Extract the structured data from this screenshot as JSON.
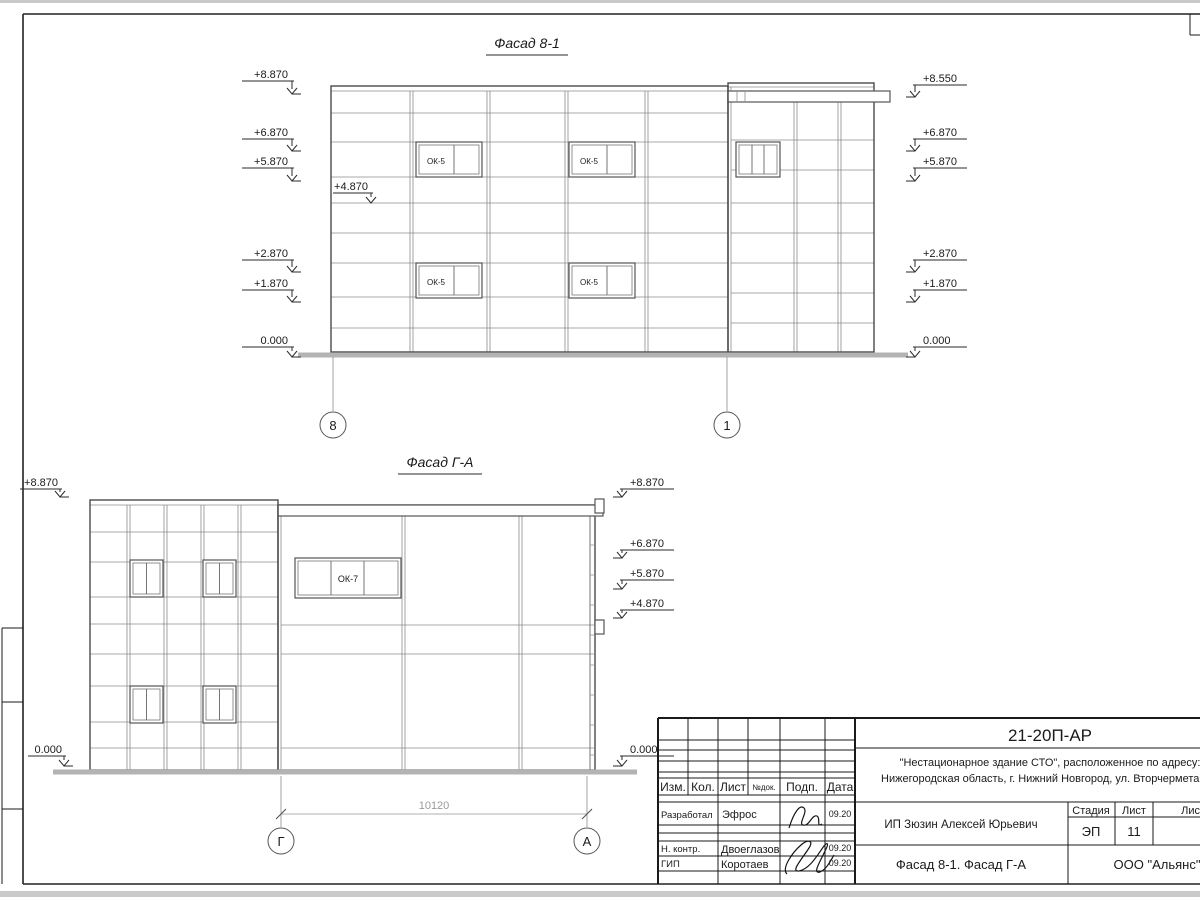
{
  "facade1": {
    "title": "Фасад 8-1",
    "left_marks": [
      "+8.870",
      "+6.870",
      "+5.870",
      "+2.870",
      "+1.870",
      "0.000"
    ],
    "mid_mark": "+4.870",
    "right_marks": [
      "+8.550",
      "+6.870",
      "+5.870",
      "+2.870",
      "+1.870",
      "0.000"
    ],
    "window_label": "ОК-5",
    "grid_bubbles": [
      "8",
      "1"
    ]
  },
  "facade2": {
    "title": "Фасад Г-А",
    "left_marks": [
      "+8.870",
      "0.000"
    ],
    "right_marks": [
      "+8.870",
      "+6.870",
      "+5.870",
      "+4.870",
      "0.000"
    ],
    "window_label": "ОК-7",
    "grid_bubbles": [
      "Г",
      "А"
    ],
    "dimension": "10120"
  },
  "titleblock": {
    "code": "21-20П-АР",
    "object_line1": "\"Нестационарное здание СТО\", расположенное по адресу:",
    "object_line2": "Нижегородская область, г. Нижний Новгород, ул. Вторчермета, 1А",
    "header": [
      "Изм.",
      "Кол.",
      "Лист",
      "№док.",
      "Подп.",
      "Дата"
    ],
    "rows": [
      {
        "role": "Разработал",
        "name": "Эфрос",
        "date": "09.20"
      },
      {
        "role": "Н. контр.",
        "name": "Двоеглазов",
        "date": "09.20"
      },
      {
        "role": "ГИП",
        "name": "Коротаев",
        "date": "09.20"
      }
    ],
    "client": "ИП Зюзин Алексей Юрьевич",
    "stage_label": "Стадия",
    "sheet_label": "Лист",
    "sheets_label": "Листов",
    "stage": "ЭП",
    "sheet": "11",
    "sheet_title": "Фасад 8-1. Фасад Г-А",
    "company": "ООО \"Альянс\""
  }
}
